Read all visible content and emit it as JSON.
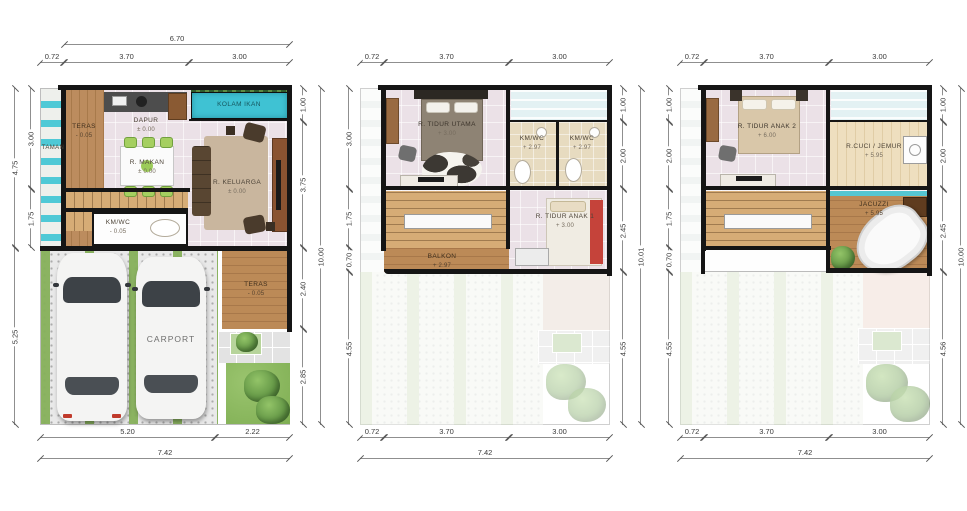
{
  "sheet": {
    "type": "architectural floor plan set",
    "palette": {
      "wall": "#151515",
      "water": "#3fc2d3",
      "wood": "#b98a5c",
      "grass": "#7fae53",
      "floor_tile": "#ebe1e7",
      "dim_text": "#3a3a3a"
    }
  },
  "plans": [
    {
      "name": "ground-floor-plan",
      "dims": {
        "top_outer": "6.70",
        "top": [
          "0.72",
          "3.70",
          "3.00"
        ],
        "left_inner": [
          "3.00",
          "1.75"
        ],
        "left_outer": [
          "4.75",
          "5.25"
        ],
        "right": [
          "1.00",
          "3.75",
          "2.40",
          "2.85"
        ],
        "right_outer": "10.00",
        "bottom": [
          "5.20",
          "2.22"
        ],
        "bottom_outer": "7.42"
      },
      "rooms": {
        "taman": {
          "label": "TAMAN"
        },
        "teras": {
          "label": "TERAS",
          "elev": "- 0.05"
        },
        "dapur": {
          "label": "DAPUR",
          "elev": "± 0.00"
        },
        "kolam_ikan": {
          "label": "KOLAM IKAN"
        },
        "r_makan": {
          "label": "R. MAKAN",
          "elev": "± 0.00"
        },
        "r_keluarga": {
          "label": "R. KELUARGA",
          "elev": "± 0.00"
        },
        "km_wc": {
          "label": "KM/WC",
          "elev": "- 0.05"
        },
        "teras2": {
          "label": "TERAS",
          "elev": "- 0.05"
        },
        "carport": {
          "label": "CARPORT"
        }
      }
    },
    {
      "name": "second-floor-plan",
      "dims": {
        "top": [
          "0.72",
          "3.70",
          "3.00"
        ],
        "left": [
          "3.00",
          "1.75",
          "0.70",
          "4.55"
        ],
        "right": [
          "1.00",
          "2.00",
          "2.45",
          "4.55"
        ],
        "right_outer": "10.01",
        "bottom": [
          "0.72",
          "3.70",
          "3.00"
        ],
        "bottom_outer": "7.42"
      },
      "rooms": {
        "r_tidur_utama": {
          "label": "R. TIDUR UTAMA",
          "elev": "+ 3.00"
        },
        "km_wc_1": {
          "label": "KM/WC",
          "elev": "+ 2.97"
        },
        "km_wc_2": {
          "label": "KM/WC",
          "elev": "+ 2.97"
        },
        "r_tidur_anak_1": {
          "label": "R. TIDUR ANAK 1",
          "elev": "+ 3.00"
        },
        "balkon": {
          "label": "BALKON",
          "elev": "+ 2.97"
        }
      }
    },
    {
      "name": "third-floor-plan",
      "dims": {
        "top": [
          "0.72",
          "3.70",
          "3.00"
        ],
        "left": [
          "1.00",
          "2.00",
          "1.75",
          "0.70",
          "4.55"
        ],
        "right": [
          "1.00",
          "2.00",
          "2.45",
          "4.56"
        ],
        "right_outer": "10.00",
        "bottom": [
          "0.72",
          "3.70",
          "3.00"
        ],
        "bottom_outer": "7.42"
      },
      "rooms": {
        "r_tidur_anak_2": {
          "label": "R. TIDUR ANAK 2",
          "elev": "+ 6.00"
        },
        "r_cuci_jemur": {
          "label": "R.CUCI / JEMUR",
          "elev": "+ 5.95"
        },
        "jacuzzi": {
          "label": "JACUZZI",
          "elev": "+ 5.95"
        }
      }
    }
  ]
}
